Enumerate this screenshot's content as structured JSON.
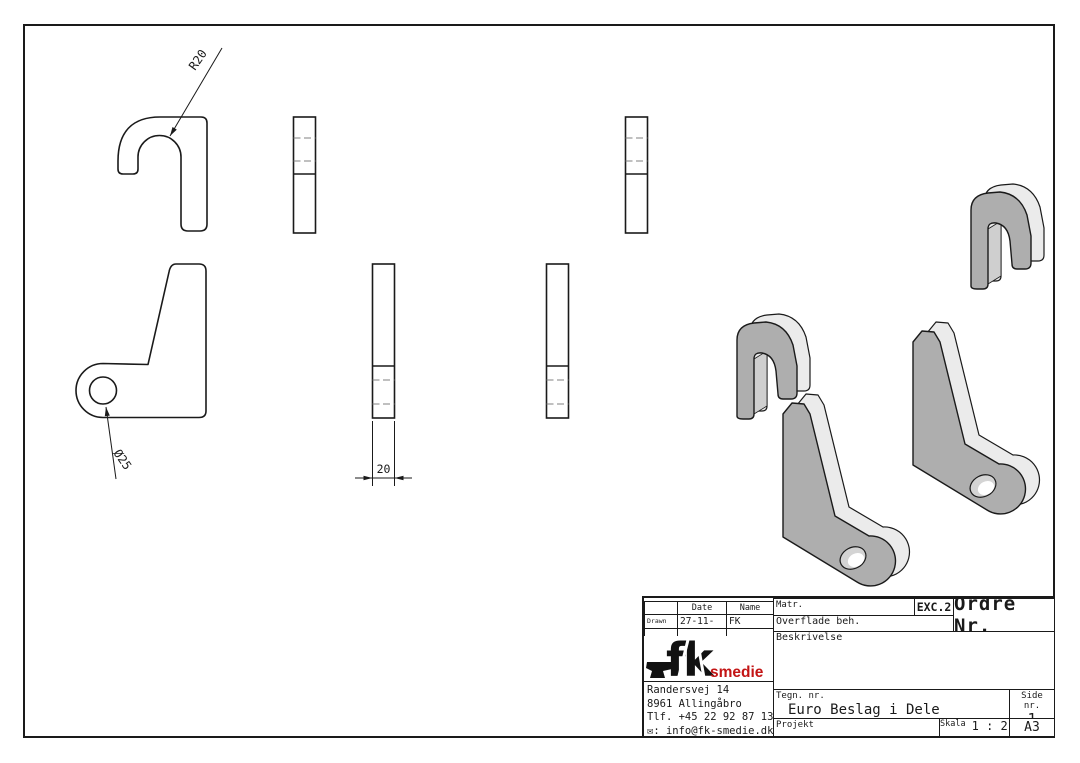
{
  "drawing": {
    "radius_annotation": "R20",
    "diameter_annotation": "Ø25",
    "thickness_dimension": "20"
  },
  "title_block": {
    "revision_table": {
      "date_header": "Date",
      "name_header": "Name",
      "drawn_label": "Drawn",
      "drawn_date": "27-11-2025",
      "drawn_name": "FK"
    },
    "matr_label": "Matr.",
    "exc_code": "EXC.2",
    "ordre_label": "Ordre Nr.",
    "overflade_label": "Overflade beh.",
    "beskrivelse_label": "Beskrivelse",
    "tegn_label": "Tegn. nr.",
    "drawing_title": "Euro Beslag i Dele",
    "side_label": "Side nr.",
    "side_value": "1",
    "projekt_label": "Projekt",
    "skala_label": "Skala",
    "skala_value": "1 : 2,5",
    "paper_size": "A3"
  },
  "company": {
    "logo_text": "fk",
    "logo_suffix": "smedie",
    "address1": "Randersvej 14",
    "address2": "8961 Allingåbro",
    "phone": "Tlf. +45 22 92 87 13",
    "email_icon": "✉",
    "email_line": ": info@fk-smedie.dk"
  },
  "colors": {
    "line": "#1a1a1a",
    "hidden_line": "#808080",
    "iso_front": "#aeaeae",
    "iso_light": "#ebebeb",
    "iso_mid": "#cfcfcf",
    "logo_red": "#c31414"
  }
}
